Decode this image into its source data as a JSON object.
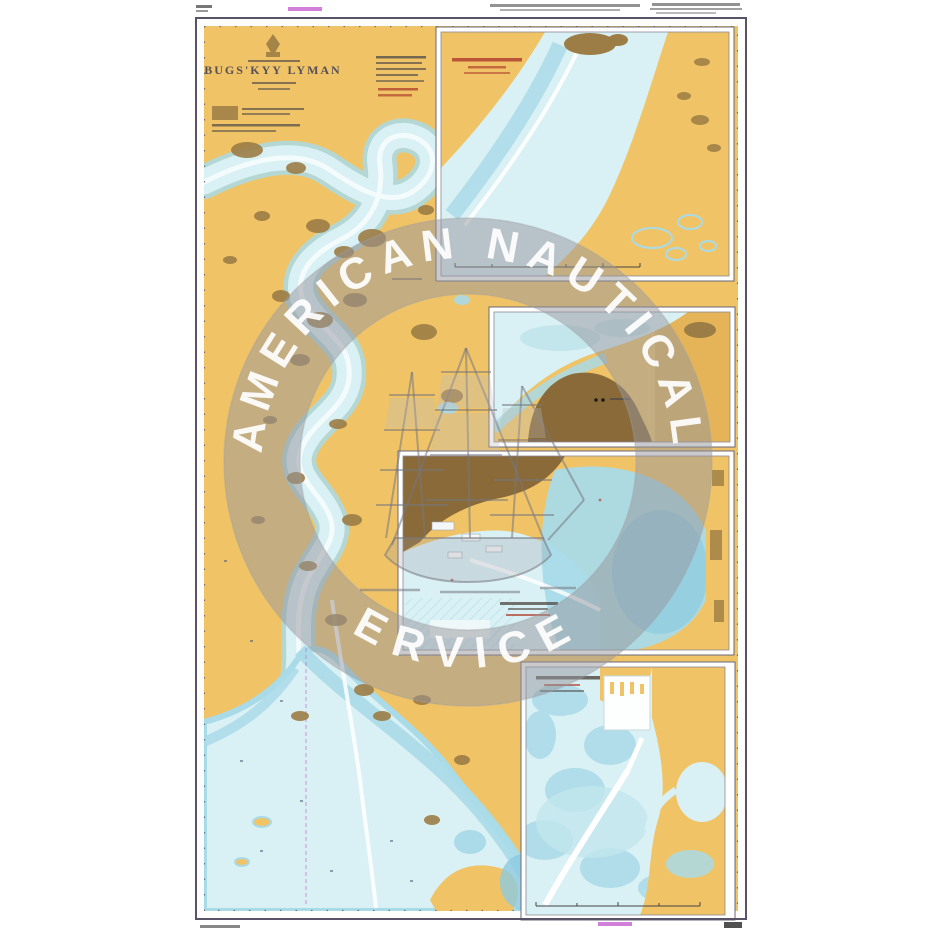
{
  "page": {
    "background": "#ffffff"
  },
  "chart": {
    "title": "BUGS'KYY LYMAN",
    "colors": {
      "land": "#f0c466",
      "land_dark": "#8a6a38",
      "mud": "#9c7d45",
      "water": "#d9f1f4",
      "shoal": "#a9dae8",
      "deep": "#8ccbe0",
      "frame": "#5a5368",
      "ink": "#55504a",
      "title_ink": "#3b3b55",
      "red_note": "#b0432f",
      "magenta": "#c75fd0",
      "paper": "#fdfdfb"
    }
  },
  "watermark": {
    "arc_top": "AMERICAN NAUTICAL",
    "arc_bottom": "SERVICES"
  }
}
